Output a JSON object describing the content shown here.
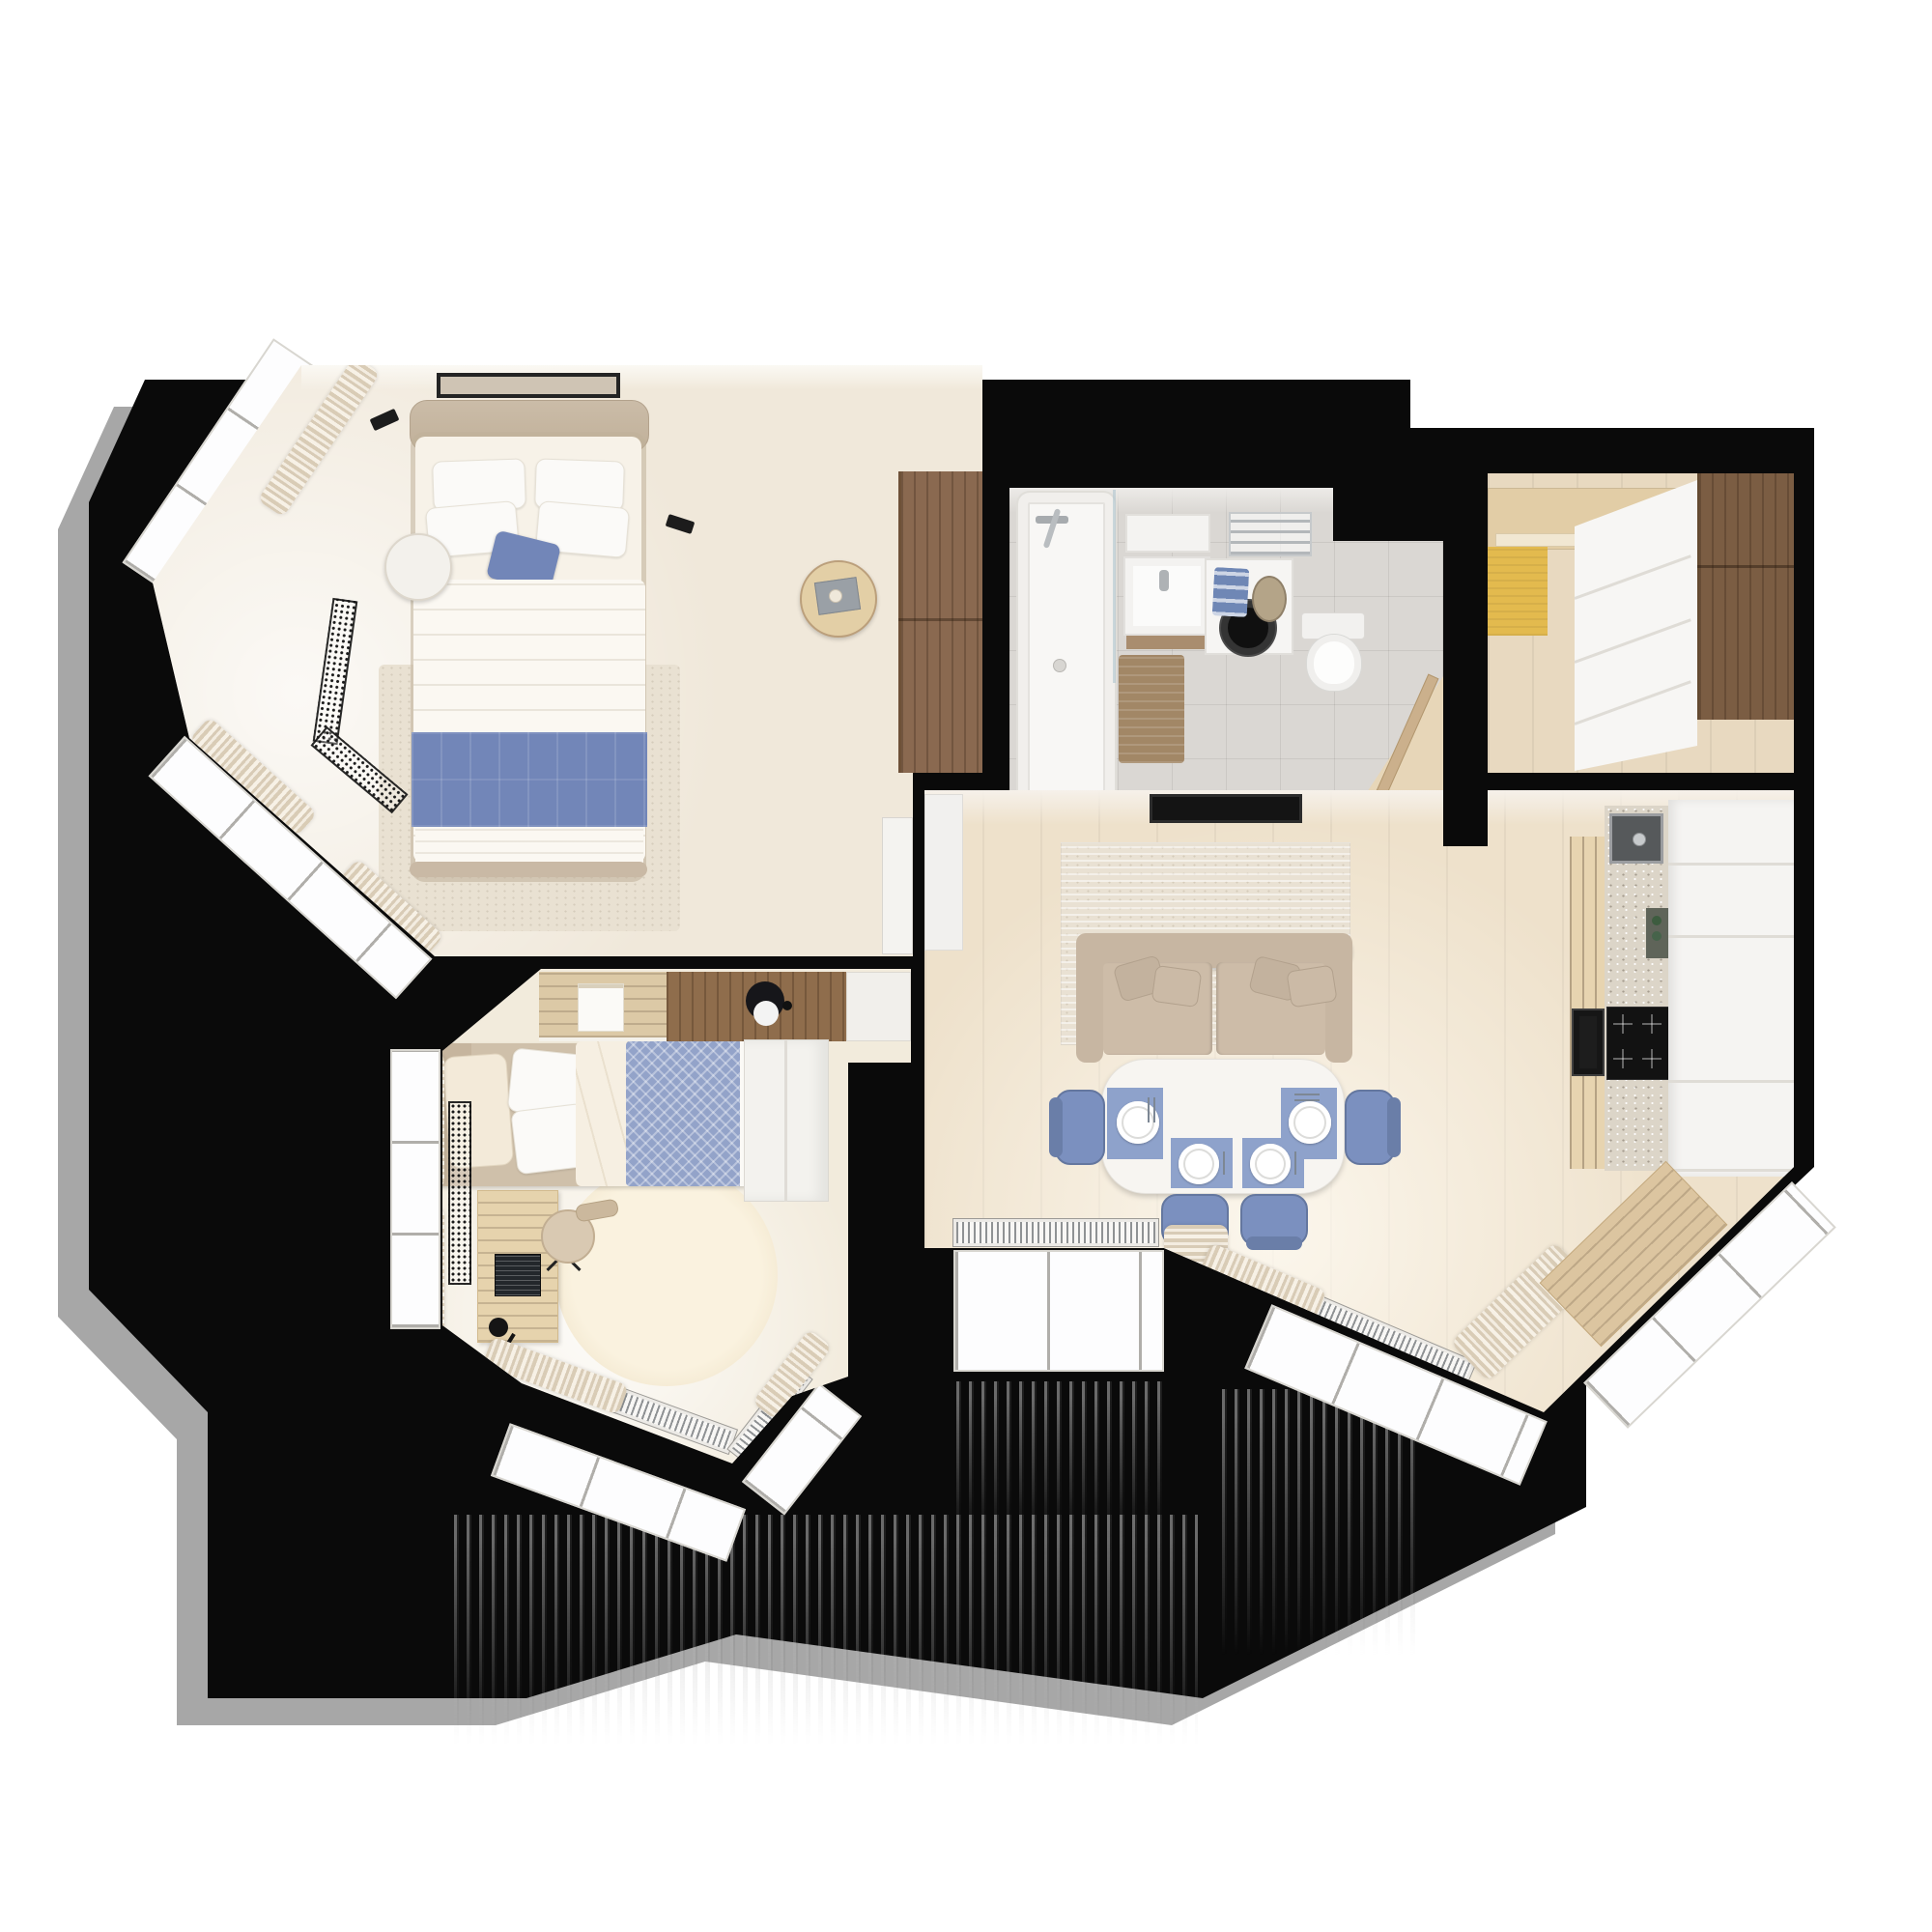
{
  "meta": {
    "image_type": "3d-rendered-floor-plan",
    "view": "top-down",
    "apartment_style": "scandinavian-two-bedroom"
  },
  "palette": {
    "canvas": "#ffffff",
    "wall": "#0a0a0a",
    "shadow": "#989898",
    "bedroomFloor": "#f0e8da",
    "kidsFloor": "#f2ebdc",
    "livingFloor": "#eee1cb",
    "hallFloor": "#e8d9c0",
    "bathFloor": "#dad7d3",
    "woodDark": "#8a6950",
    "woodCabinet": "#7b5d43",
    "woodLight": "#e3cfa6",
    "woodDesk": "#e6d3ad",
    "cream": "#f6f1e7",
    "beigeSofa": "#c7b6a2",
    "beigeBed": "#cfc0aa",
    "blue": "#7286b8",
    "blueChair": "#7b90bf",
    "blueMat": "#8ea2cb",
    "blueBlanket": "#93a3c9",
    "blueTowel": "#6f87b5",
    "yellow": "#e3ba4e",
    "terrazzo": "#dcd5c8",
    "appliance": "#141414",
    "white": "#fbfaf8",
    "curtain1": "#d8cbb6",
    "curtain2": "#f3ece0",
    "radiatorDot": "#1a1a1a"
  },
  "rooms": [
    {
      "id": "master-bedroom",
      "label": "Master bedroom",
      "furniture": [
        "double-bed",
        "white-pillows",
        "blue-accent-cushion",
        "blue-bed-runner",
        "picture-frame",
        "round-nightstand-left",
        "round-nightstand-right",
        "wall-reading-lamps",
        "brown-wardrobe",
        "area-rug",
        "bay-windows",
        "curtains",
        "floor-convector-radiators",
        "door-leaf"
      ]
    },
    {
      "id": "bathroom",
      "label": "Bathroom",
      "furniture": [
        "bathtub",
        "shower-mixer",
        "glass-screen",
        "vanity-sink",
        "mirror-shelf",
        "washing-machine",
        "blue-towels",
        "storage-basket",
        "towel-rail",
        "wall-hung-toilet",
        "bath-mat",
        "open-door"
      ]
    },
    {
      "id": "entry-hall",
      "label": "Entry hall",
      "furniture": [
        "entrance-door",
        "yellow-doormat",
        "white-sliding-wardrobe",
        "tall-brown-cabinet"
      ]
    },
    {
      "id": "living-kitchen",
      "label": "Living room with kitchen",
      "furniture": [
        "tv-panel",
        "media-cabinet",
        "area-rug",
        "two-seat-sofa",
        "sofa-pillows",
        "dining-table",
        "blue-placemats",
        "plates",
        "cutlery",
        "blue-chairs",
        "kitchen-counter",
        "terrazzo-worktop",
        "sink",
        "cooktop",
        "built-in-oven",
        "tall-white-cabinets",
        "wood-bench",
        "floor-radiators",
        "panorama-windows",
        "curtains"
      ]
    },
    {
      "id": "kids-room",
      "label": "Kids room",
      "furniture": [
        "single-bed",
        "blue-chevron-blanket",
        "pillows",
        "wall-shelf-unit",
        "panda-plush",
        "poster",
        "desk",
        "laptop",
        "desk-lamp",
        "desk-chair",
        "round-rug",
        "white-wardrobe",
        "bay-windows",
        "curtains",
        "radiators"
      ]
    }
  ],
  "counts": {
    "dining_chairs": 4,
    "placemats": 4,
    "plates": 4,
    "sofa_pillows": 4,
    "bed_pillows": 4,
    "rooms": 5
  }
}
